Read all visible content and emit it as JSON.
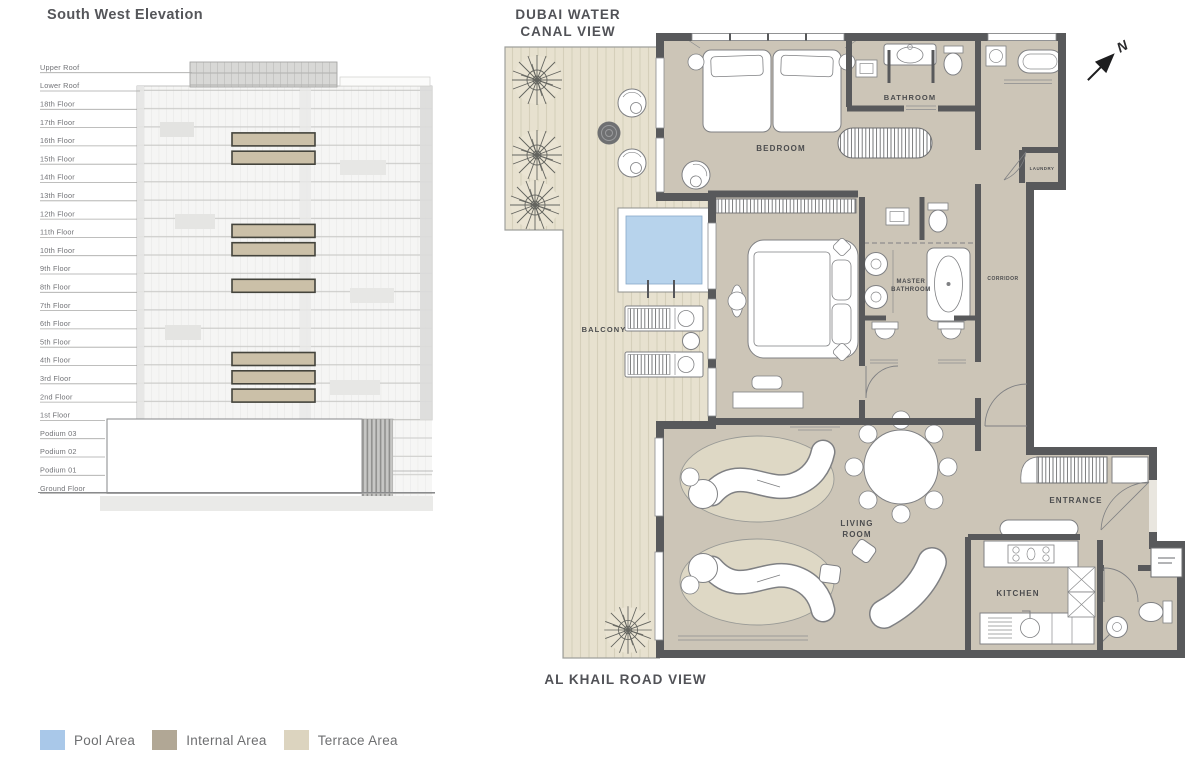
{
  "elevation": {
    "title": "South West Elevation",
    "floors": [
      {
        "label": "Upper Roof"
      },
      {
        "label": "Lower Roof"
      },
      {
        "label": "18th Floor"
      },
      {
        "label": "17th Floor"
      },
      {
        "label": "16th Floor"
      },
      {
        "label": "15th Floor"
      },
      {
        "label": "14th Floor"
      },
      {
        "label": "13th Floor"
      },
      {
        "label": "12th Floor"
      },
      {
        "label": "11th Floor"
      },
      {
        "label": "10th Floor"
      },
      {
        "label": "9th Floor"
      },
      {
        "label": "8th Floor"
      },
      {
        "label": "7th Floor"
      },
      {
        "label": "6th Floor"
      },
      {
        "label": "5th Floor"
      },
      {
        "label": "4th Floor"
      },
      {
        "label": "3rd Floor"
      },
      {
        "label": "2nd Floor"
      },
      {
        "label": "1st Floor"
      },
      {
        "label": "Podium 03"
      },
      {
        "label": "Podium 02"
      },
      {
        "label": "Podium 01"
      },
      {
        "label": "Ground Floor"
      }
    ],
    "highlighted_floors": [
      "16th Floor",
      "15th Floor",
      "11th Floor",
      "10th Floor",
      "8th Floor",
      "4th Floor",
      "3rd Floor",
      "2nd Floor"
    ]
  },
  "plan": {
    "top_view_label_lines": [
      "DUBAI WATER",
      "CANAL VIEW"
    ],
    "bottom_view_label": "AL KHAIL ROAD VIEW",
    "compass_label": "N",
    "rooms": {
      "bedroom": "BEDROOM",
      "bathroom": "BATHROOM",
      "laundry": "LAUNDRY",
      "master_bathroom_lines": [
        "MASTER",
        "BATHROOM"
      ],
      "corridor": "CORRIDOR",
      "balcony": "BALCONY",
      "living_room_lines": [
        "LIVING",
        "ROOM"
      ],
      "entrance": "ENTRANCE",
      "kitchen": "KITCHEN"
    }
  },
  "legend": {
    "items": [
      {
        "label": "Pool Area",
        "color": "#a9c8e9"
      },
      {
        "label": "Internal Area",
        "color": "#b1a795"
      },
      {
        "label": "Terrace Area",
        "color": "#dcd4bf"
      }
    ]
  },
  "colors": {
    "wall": "#58595b",
    "internal_fill": "#ccc5b7",
    "terrace_fill": "#e7e1cf",
    "pool_water": "#b7d3ec",
    "rug_fill": "#ded8c5",
    "unit_highlight": "#cbc0a8"
  }
}
